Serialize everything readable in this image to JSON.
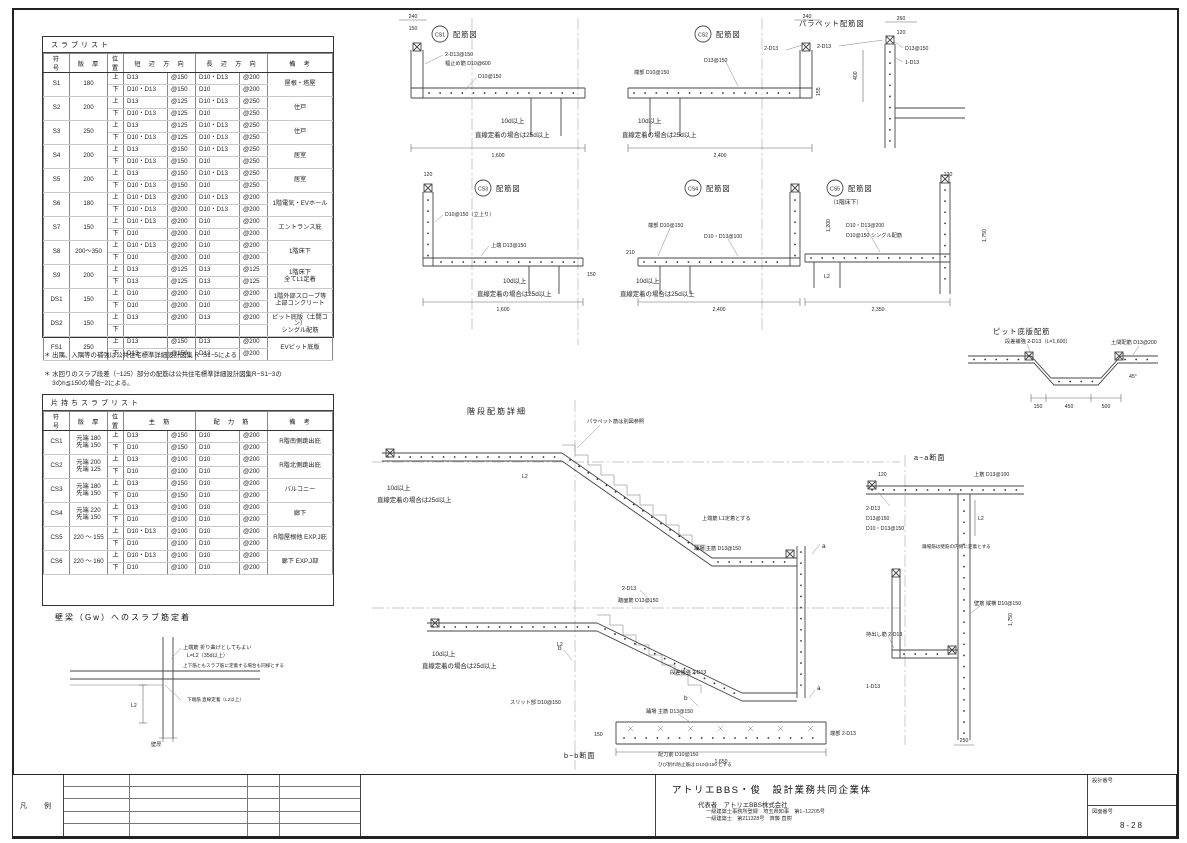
{
  "tables": {
    "slab": {
      "title": "スラブリスト",
      "headers": {
        "code": "符　号",
        "thickness": "版　厚",
        "pos": "位置",
        "g1": "短　辺　方　向",
        "g2": "長　辺　方　向",
        "remark": "備　考"
      },
      "rows": [
        {
          "code": "S1",
          "thickness": "180",
          "remark": "屋根・塔屋",
          "subs": [
            {
              "pos": "上",
              "b1": "D13",
              "p1": "@150",
              "b2": "D10・D13",
              "p2": "@200"
            },
            {
              "pos": "下",
              "b1": "D10・D13",
              "p1": "@150",
              "b2": "D10",
              "p2": "@200"
            }
          ]
        },
        {
          "code": "S2",
          "thickness": "200",
          "remark": "住戸",
          "subs": [
            {
              "pos": "上",
              "b1": "D13",
              "p1": "@125",
              "b2": "D10・D13",
              "p2": "@250"
            },
            {
              "pos": "下",
              "b1": "D10・D13",
              "p1": "@125",
              "b2": "D10",
              "p2": "@250"
            }
          ]
        },
        {
          "code": "S3",
          "thickness": "250",
          "remark": "住戸",
          "subs": [
            {
              "pos": "上",
              "b1": "D13",
              "p1": "@125",
              "b2": "D10・D13",
              "p2": "@250"
            },
            {
              "pos": "下",
              "b1": "D10・D13",
              "p1": "@125",
              "b2": "D10・D13",
              "p2": "@250"
            }
          ]
        },
        {
          "code": "S4",
          "thickness": "200",
          "remark": "居室",
          "subs": [
            {
              "pos": "上",
              "b1": "D13",
              "p1": "@150",
              "b2": "D10・D13",
              "p2": "@250"
            },
            {
              "pos": "下",
              "b1": "D10・D13",
              "p1": "@150",
              "b2": "D10",
              "p2": "@250"
            }
          ]
        },
        {
          "code": "S5",
          "thickness": "200",
          "remark": "居室",
          "subs": [
            {
              "pos": "上",
              "b1": "D13",
              "p1": "@150",
              "b2": "D10・D13",
              "p2": "@250"
            },
            {
              "pos": "下",
              "b1": "D10・D13",
              "p1": "@150",
              "b2": "D10",
              "p2": "@250"
            }
          ]
        },
        {
          "code": "S6",
          "thickness": "180",
          "remark": "1階電気・EVホール",
          "subs": [
            {
              "pos": "上",
              "b1": "D10・D13",
              "p1": "@200",
              "b2": "D10・D13",
              "p2": "@200"
            },
            {
              "pos": "下",
              "b1": "D10・D13",
              "p1": "@200",
              "b2": "D10・D13",
              "p2": "@200"
            }
          ]
        },
        {
          "code": "S7",
          "thickness": "150",
          "remark": "エントランス庇",
          "subs": [
            {
              "pos": "上",
              "b1": "D10・D13",
              "p1": "@200",
              "b2": "D10",
              "p2": "@200"
            },
            {
              "pos": "下",
              "b1": "D10",
              "p1": "@200",
              "b2": "D10",
              "p2": "@200"
            }
          ]
        },
        {
          "code": "S8",
          "thickness": "200〜350",
          "remark": "1階床下",
          "subs": [
            {
              "pos": "上",
              "b1": "D10・D13",
              "p1": "@200",
              "b2": "D10",
              "p2": "@200"
            },
            {
              "pos": "下",
              "b1": "D10",
              "p1": "@200",
              "b2": "D10",
              "p2": "@200"
            }
          ]
        },
        {
          "code": "S9",
          "thickness": "200",
          "remark": "1階床下\n全てL1定着",
          "subs": [
            {
              "pos": "上",
              "b1": "D13",
              "p1": "@125",
              "b2": "D13",
              "p2": "@125"
            },
            {
              "pos": "下",
              "b1": "D13",
              "p1": "@125",
              "b2": "D13",
              "p2": "@125"
            }
          ]
        },
        {
          "code": "DS1",
          "thickness": "150",
          "remark": "1階外部スロープ等\n上部コンクリート",
          "subs": [
            {
              "pos": "上",
              "b1": "D10",
              "p1": "@200",
              "b2": "D10",
              "p2": "@200"
            },
            {
              "pos": "下",
              "b1": "D10",
              "p1": "@200",
              "b2": "D10",
              "p2": "@200"
            }
          ]
        },
        {
          "code": "DS2",
          "thickness": "150",
          "remark": "ピット底版（土間コン）\nシングル配筋",
          "subs": [
            {
              "pos": "上",
              "b1": "D13",
              "p1": "@200",
              "b2": "D13",
              "p2": "@200"
            },
            {
              "pos": "下",
              "b1": "",
              "p1": "",
              "b2": "",
              "p2": ""
            }
          ]
        },
        {
          "code": "FS1",
          "thickness": "250",
          "remark": "EVピット底版",
          "subs": [
            {
              "pos": "上",
              "b1": "D13",
              "p1": "@150",
              "b2": "D13",
              "p2": "@200"
            },
            {
              "pos": "下",
              "b1": "D13",
              "p1": "@150",
              "b2": "D13",
              "p2": "@200"
            }
          ]
        }
      ]
    },
    "cant": {
      "title": "片持ちスラブリスト",
      "headers": {
        "code": "符　号",
        "thickness": "版　厚",
        "pos": "位置",
        "g1": "主　筋",
        "g2": "配　力　筋",
        "remark": "備　考"
      },
      "rows": [
        {
          "code": "CS1",
          "thickness": "元端 180\n先端 150",
          "remark": "R階南側跳出庇",
          "subs": [
            {
              "pos": "上",
              "b1": "D13",
              "p1": "@150",
              "b2": "D10",
              "p2": "@200"
            },
            {
              "pos": "下",
              "b1": "D10",
              "p1": "@150",
              "b2": "D10",
              "p2": "@200"
            }
          ]
        },
        {
          "code": "CS2",
          "thickness": "元端 200\n先端 125",
          "remark": "R階北側跳出庇",
          "subs": [
            {
              "pos": "上",
              "b1": "D13",
              "p1": "@100",
              "b2": "D10",
              "p2": "@200"
            },
            {
              "pos": "下",
              "b1": "D10",
              "p1": "@100",
              "b2": "D10",
              "p2": "@200"
            }
          ]
        },
        {
          "code": "CS3",
          "thickness": "元端 180\n先端 150",
          "remark": "バルコニー",
          "subs": [
            {
              "pos": "上",
              "b1": "D13",
              "p1": "@150",
              "b2": "D10",
              "p2": "@200"
            },
            {
              "pos": "下",
              "b1": "D10",
              "p1": "@150",
              "b2": "D10",
              "p2": "@200"
            }
          ]
        },
        {
          "code": "CS4",
          "thickness": "元端 220\n先端 150",
          "remark": "廊下",
          "subs": [
            {
              "pos": "上",
              "b1": "D13",
              "p1": "@100",
              "b2": "D10",
              "p2": "@200"
            },
            {
              "pos": "下",
              "b1": "D10",
              "p1": "@100",
              "b2": "D10",
              "p2": "@200"
            }
          ]
        },
        {
          "code": "CS5",
          "thickness": "220 〜 155",
          "remark": "R階屋根他 EXP.J庇",
          "subs": [
            {
              "pos": "上",
              "b1": "D10・D13",
              "p1": "@100",
              "b2": "D10",
              "p2": "@200"
            },
            {
              "pos": "下",
              "b1": "D10",
              "p1": "@100",
              "b2": "D10",
              "p2": "@200"
            }
          ]
        },
        {
          "code": "CS6",
          "thickness": "220 〜 160",
          "remark": "廊下 EXP.J部",
          "subs": [
            {
              "pos": "上",
              "b1": "D10・D13",
              "p1": "@100",
              "b2": "D10",
              "p2": "@200"
            },
            {
              "pos": "下",
              "b1": "D10",
              "p1": "@100",
              "b2": "D10",
              "p2": "@200"
            }
          ]
        }
      ]
    }
  },
  "notes": {
    "n1": "＊ 出隅、入隅等の補強は公共住宅標準詳細設計図集 R−S1−5による",
    "n2": "＊ 水回りのスラブ段差（−125）部分の配筋は公共住宅標準詳細設計図集R−S1−3の\n　  3のh≦150の場合−2による。"
  },
  "gw": {
    "title": "壁梁（Gw）へのスラブ筋定着",
    "a1": "上端筋 折り曲げとしてもよい",
    "a2": "L=L2（35d以上）",
    "a3": "上下筋ともスラブ筋に定着する場合も同様とする",
    "a4": "下端筋 直線定着（L2以上）",
    "wall": "壁厚",
    "l2": "L2"
  },
  "details": {
    "common": {
      "title": "配筋図",
      "note1": "10d以上",
      "note2": "直線定着の場合は25d以上"
    },
    "d1": {
      "label": "CS1",
      "dim_top": "240",
      "dim_top2": "150",
      "dim_bottom": "1,600",
      "a1": "2-D13@150",
      "a2": "幅止め筋 D10@600",
      "a3": "D10@150"
    },
    "d2": {
      "label": "CS2",
      "dim_top": "240",
      "dim_right": "155",
      "dim_bottom": "2,400",
      "a1": "2-D13",
      "a2": "D13@150",
      "a3": "端部 D10@150"
    },
    "d3": {
      "title": "パラペット配筋図",
      "dim_top": "260",
      "dim_top2": "120",
      "dim_left": "400",
      "a1": "2-D13",
      "a2": "D13@150",
      "a3": "1-D13"
    },
    "d4": {
      "label": "CS3",
      "dim_top": "120",
      "dim_right": "150",
      "dim_bottom": "1,600",
      "a1": "D10@150（立上り）",
      "a2": "上端 D13@150"
    },
    "d5": {
      "label": "CS4",
      "dim_left": "210",
      "dim_right": "1,200",
      "dim_bottom": "2,400",
      "a1": "端部 D10@150",
      "a2": "D10・D13@100"
    },
    "d6": {
      "label": "CS5",
      "sub": "（1階床下）",
      "dim_top": "120",
      "dim_right": "1,750",
      "dim_bottom": "2,350",
      "a1": "D10・D13@200",
      "a2": "D10@150 シングル配筋",
      "l2": "L2"
    },
    "pit": {
      "title": "ピット底版配筋",
      "a1": "段差補強 2-D13（L=1,600）",
      "a2": "土間配筋 D13@200",
      "d1": "150",
      "d2": "450",
      "d3": "500",
      "angle": "45°"
    },
    "stair": {
      "title": "階段配筋詳細",
      "a1": "パラペット筋は別図参照",
      "a2": "上端筋 L1定着とする",
      "a3": "踊場 主筋 D13@150",
      "a4": "2-D13",
      "a5": "踏面筋 D13@150",
      "a6": "段差補強 2-D13",
      "a7": "スリット部 D10@150",
      "ma": "a",
      "mb": "b",
      "l2": "L2"
    },
    "aa": {
      "title": "a−a断面",
      "note": "踊場筋は壁筋の内側に定着とする",
      "a1": "2-D13",
      "a2": "D13@150",
      "a3": "D10・D13@150",
      "a4": "上筋 D13@100",
      "a5": "壁筋 縦横 D10@150",
      "a6": "持出し筋 2-D13",
      "a7": "1-D13",
      "dim_top": "120",
      "dim_bottom": "250",
      "dim_right": "1,750",
      "l2": "L2"
    },
    "bb": {
      "title": "b−b断面",
      "a1": "踊場 主筋 D13@150",
      "a2": "配力筋 D10@150",
      "a3": "ひび割れ防止筋は D10@150 とする",
      "a4": "端部 2-D13",
      "dim_left": "150",
      "dim_bottom": "1,650"
    }
  },
  "title_block": {
    "company": "アトリエBBS・俊　設計業務共同企業体",
    "rep": "代表者　アトリエBBS株式会社",
    "lic1": "一級建築士事務所登録　埼玉県知事　第1−12205号",
    "lic2": "一級建築士　第211328号　斉藤 直樹",
    "design_no_label": "設計番号",
    "drawing_no_label": "図面番号",
    "drawing_no": "8-28",
    "revision_label": "凡　例"
  }
}
